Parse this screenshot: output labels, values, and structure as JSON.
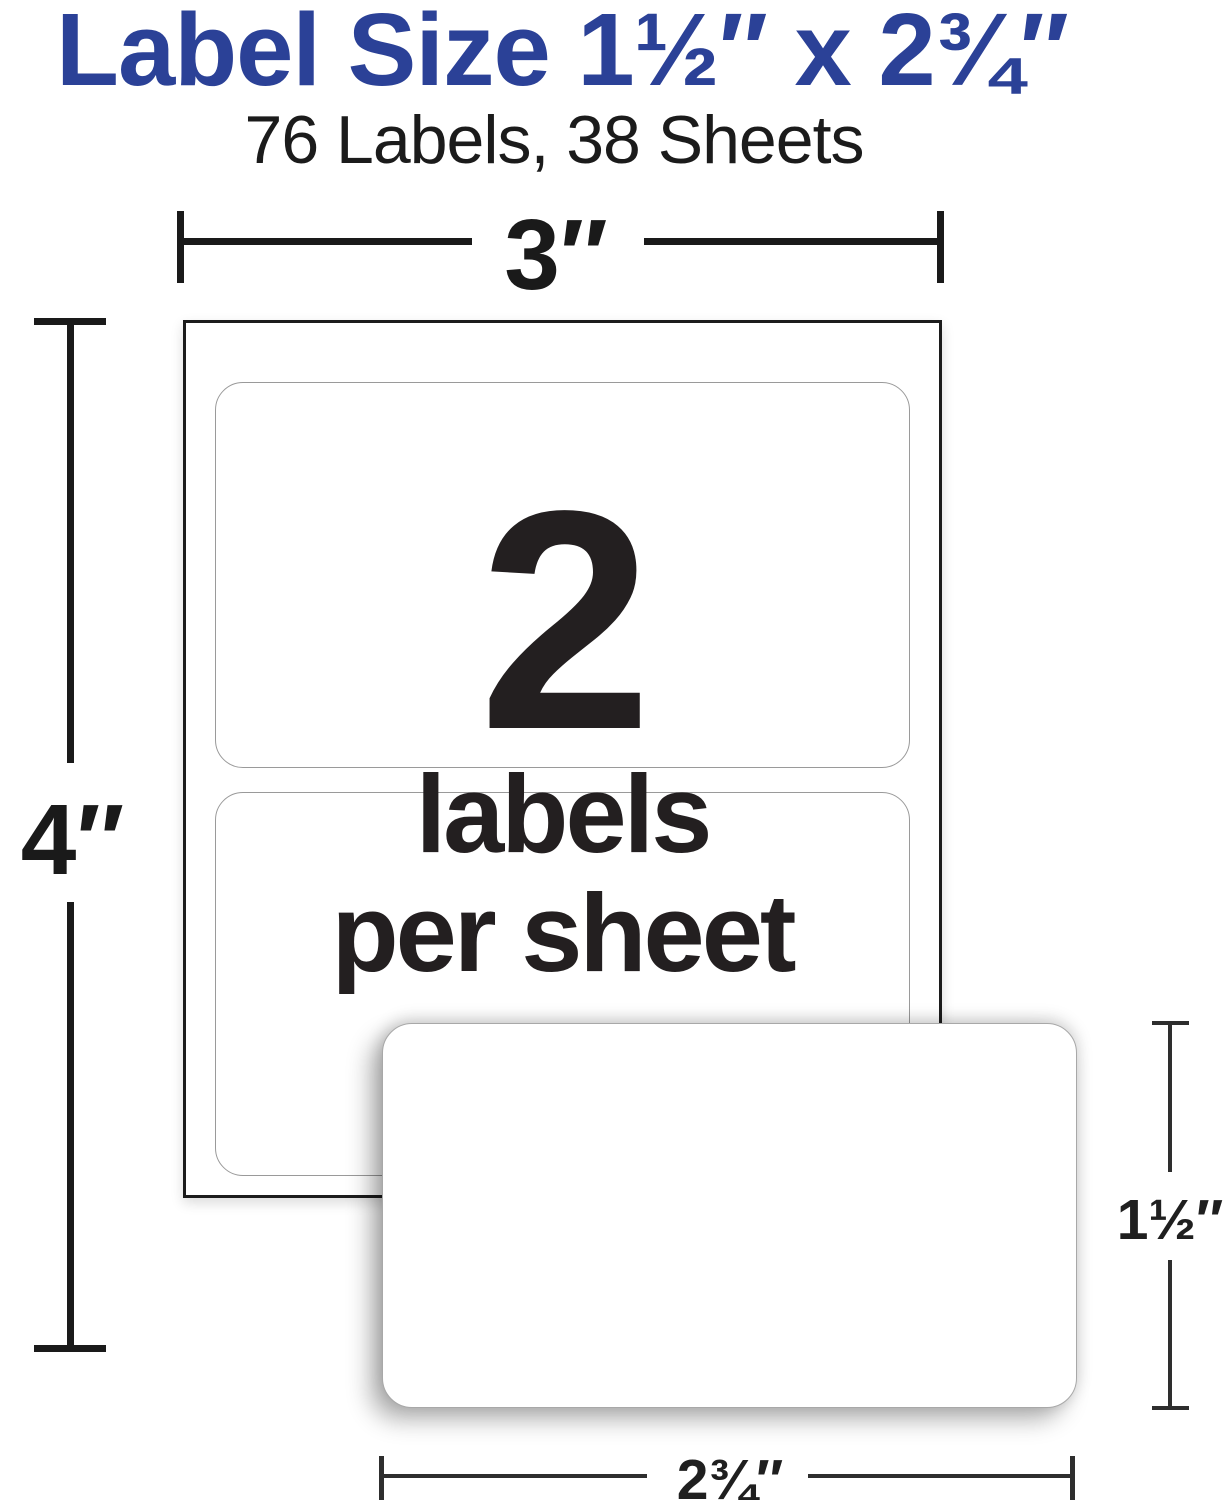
{
  "theme": {
    "background": "#ffffff",
    "accent_blue": "#2b4197",
    "ink": "#231f20",
    "dim_line_thick": "#1a1a1a",
    "dim_line_thin": "#2e2e2e",
    "label_border_gray": "#9a9a9a"
  },
  "header": {
    "title": "Label Size 1½″ x 2¾″",
    "subtitle": "76 Labels, 38 Sheets"
  },
  "diagram": {
    "sheet": {
      "width_dim": "3″",
      "height_dim": "4″",
      "big_count": "2",
      "caption_line1": "labels",
      "caption_line2": "per sheet",
      "labels_per_sheet": 2
    },
    "single_label": {
      "height_dim": "1½″",
      "width_dim": "2¾″"
    }
  }
}
